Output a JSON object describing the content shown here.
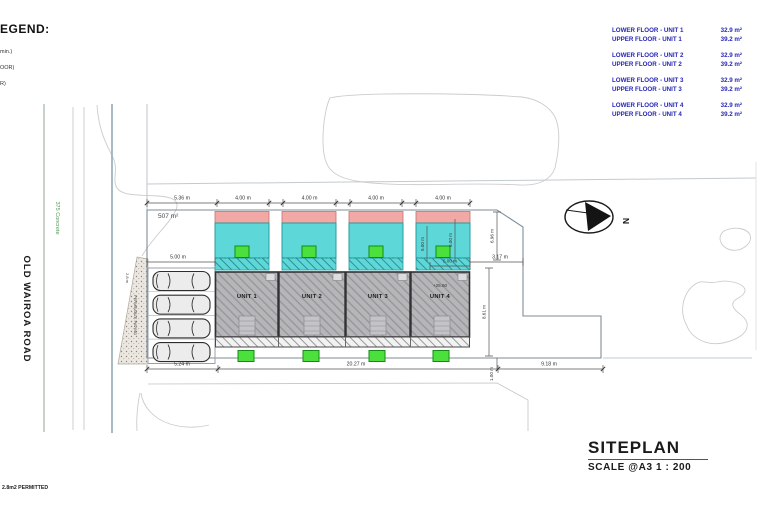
{
  "legend": {
    "title": "EGEND:",
    "items": [
      "min.)",
      "OOR)",
      "R)"
    ]
  },
  "area_schedule": {
    "rows": [
      {
        "label": "LOWER FLOOR - UNIT 1",
        "value": "32.9 m²"
      },
      {
        "label": "UPPER FLOOR - UNIT 1",
        "value": "39.2 m²"
      },
      {
        "label": "LOWER FLOOR - UNIT 2",
        "value": "32.9 m²"
      },
      {
        "label": "UPPER FLOOR - UNIT 2",
        "value": "39.2 m²"
      },
      {
        "label": "LOWER FLOOR - UNIT 3",
        "value": "32.9 m²"
      },
      {
        "label": "UPPER FLOOR - UNIT 3",
        "value": "39.2 m²"
      },
      {
        "label": "LOWER FLOOR - UNIT 4",
        "value": "32.9 m²"
      },
      {
        "label": "UPPER FLOOR - UNIT 4",
        "value": "39.2 m²"
      }
    ]
  },
  "road": {
    "name": "OLD WAIROA ROAD",
    "surface_note": "375 Concrete"
  },
  "site": {
    "area": "507 m²",
    "level_note": "+25.60",
    "permitted_note": "2.8m2 PERMITTED"
  },
  "units": {
    "unit1": "UNIT 1",
    "unit2": "UNIT 2",
    "unit3": "UNIT 3",
    "unit4": "UNIT 4"
  },
  "paving": {
    "label": "PERMEABLE PAVING",
    "width": "2.8 m"
  },
  "north": {
    "label": "N"
  },
  "dims": {
    "top": [
      "5.36 m",
      "4.00 m",
      "4.00 m",
      "4.00 m",
      "4.00 m"
    ],
    "bottom": [
      "5.24 m",
      "20.27 m",
      "9.18 m"
    ],
    "parking_width": "5.00 m",
    "unit4_width": "5.00 m",
    "unit4_depth_a": "5.00 m",
    "unit4_depth_b": "6.00 m",
    "east_top": "6.96 m",
    "east_gap": "3.17 m",
    "east_side": "8.61 m",
    "east_small": "1.00 m"
  },
  "title_block": {
    "title": "SITEPLAN",
    "scale": "SCALE @A3  1 : 200"
  },
  "colors": {
    "upper_floor": "#5ed7d8",
    "roof_strip": "#f2a8a4",
    "entry_marker": "#4ce03c",
    "lower_floor": "#b6b6b8",
    "schedule_text": "#2626b4"
  }
}
